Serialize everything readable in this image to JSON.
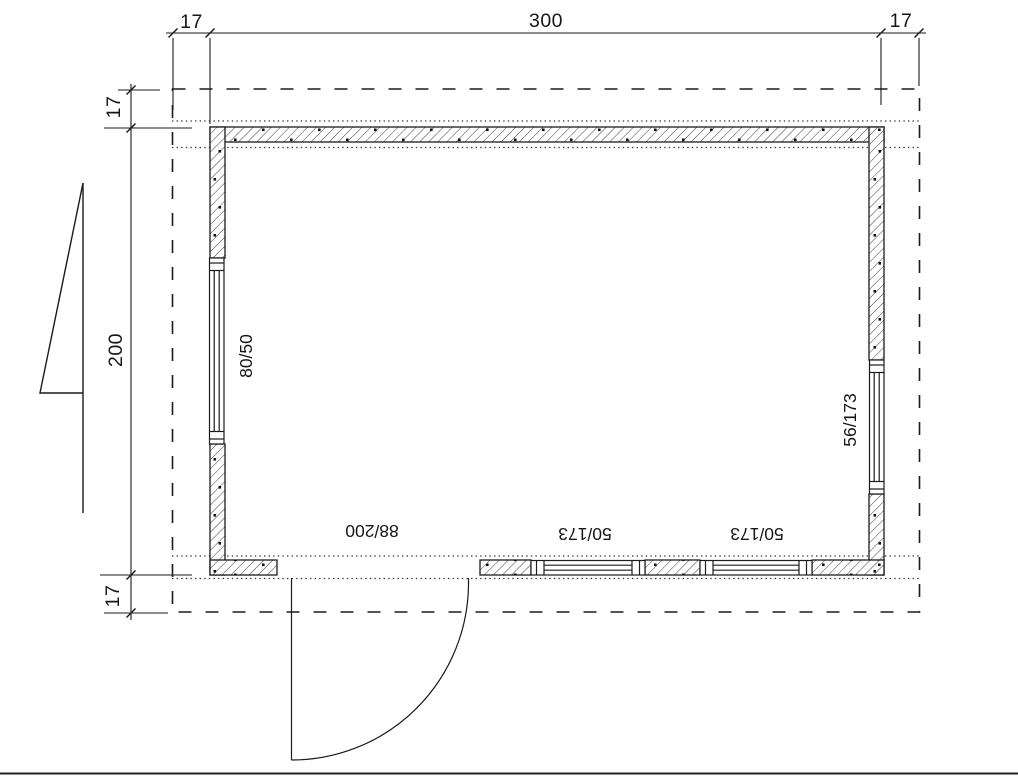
{
  "drawing_title": "floor-plan",
  "dimensions": {
    "top": {
      "left_overhang": "17",
      "width": "300",
      "right_overhang": "17"
    },
    "left": {
      "top_overhang": "17",
      "height": "200",
      "bottom_overhang": "17"
    }
  },
  "openings": {
    "window_left": "80/50",
    "window_right": "56/173",
    "door_bottom": "88/200",
    "window_bottom_left": "50/173",
    "window_bottom_right": "50/173"
  },
  "colors": {
    "line": "#1b1b1b",
    "background": "#ffffff"
  }
}
